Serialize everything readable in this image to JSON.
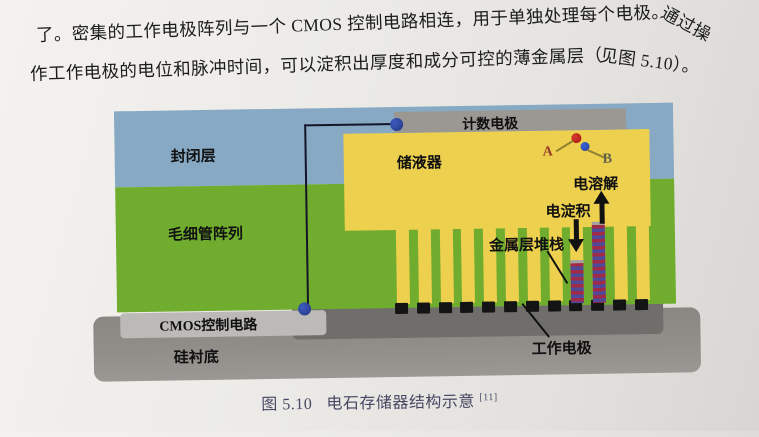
{
  "paragraph": {
    "line1": "了。密集的工作电极阵列与一个 CMOS 控制电路相连，用于单独处理每个电极。",
    "line1_tail": "通过操",
    "line2": "作工作电极的电位和脉冲时间，可以淀积出厚度和成分可控的薄金属层（",
    "line2_tail": "见图 5.10）。"
  },
  "diagram": {
    "labels": {
      "sealing_layer": "封闭层",
      "capillary_array": "毛细管阵列",
      "counting_electrode": "计数电极",
      "reservoir": "储液器",
      "cmos_circuit": "CMOS控制电路",
      "substrate": "硅衬底",
      "electro_dissolution": "电溶解",
      "electro_deposition": "电淀积",
      "metal_stack": "金属层堆栈",
      "working_electrode": "工作电极",
      "point_a": "A",
      "point_b": "B"
    },
    "capillary_count": 12,
    "electrode_count": 12,
    "colors": {
      "sealing_layer": "#87a9c4",
      "capillary_array": "#70ad2e",
      "reservoir": "#edd04d",
      "counting_electrode": "#9b9894",
      "cmos_bar": "#bcbab6",
      "dark_electrode_bar": "#6f6e6a",
      "substrate": "#908d89",
      "working_electrode": "#141414",
      "wire_contact": "#2b3f9f",
      "stack_red": "#a02a48",
      "stack_blue": "#4c4a99",
      "dot_a": "#c22318",
      "dot_b": "#2a4fbb",
      "caption_text": "#474763"
    }
  },
  "caption": {
    "figure_number": "图 5.10",
    "title": "电石存储器结构示意",
    "reference": "[11]"
  }
}
